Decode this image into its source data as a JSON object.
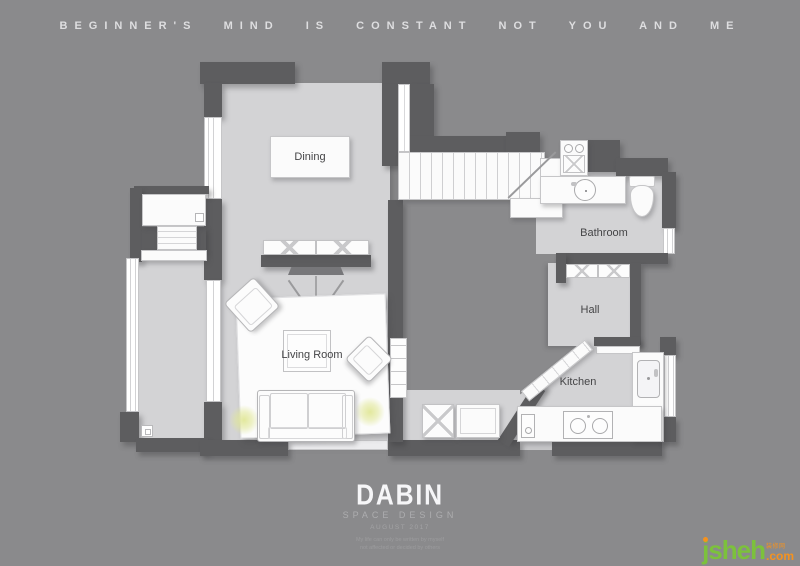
{
  "motto": "BEGINNER'S MIND IS CONSTANT NOT YOU AND ME",
  "plan": {
    "labels": {
      "dining": "Dining",
      "living_room": "Living Room",
      "bathroom": "Bathroom",
      "hall": "Hall",
      "kitchen": "Kitchen"
    }
  },
  "footer": {
    "brand": "DABIN",
    "subtitle": "SPACE DESIGN",
    "date": "AUGUST 2017",
    "fine_print_line1": "My life can only be written by myself",
    "fine_print_line2": "not affected or decided by others"
  },
  "watermark": {
    "site": "jsheh",
    "suffix": ".com",
    "tagline": "装修网"
  },
  "colors": {
    "background": "#8a8a8c",
    "floor": "#d3d3d5",
    "wall": "#5d5d5f",
    "furniture_white": "#fbfbfb",
    "lamp_glow": "#e1e798",
    "watermark_green": "#7cc13c",
    "watermark_orange": "#f5921e",
    "label_text": "#454547",
    "motto_text": "#dedee0"
  }
}
